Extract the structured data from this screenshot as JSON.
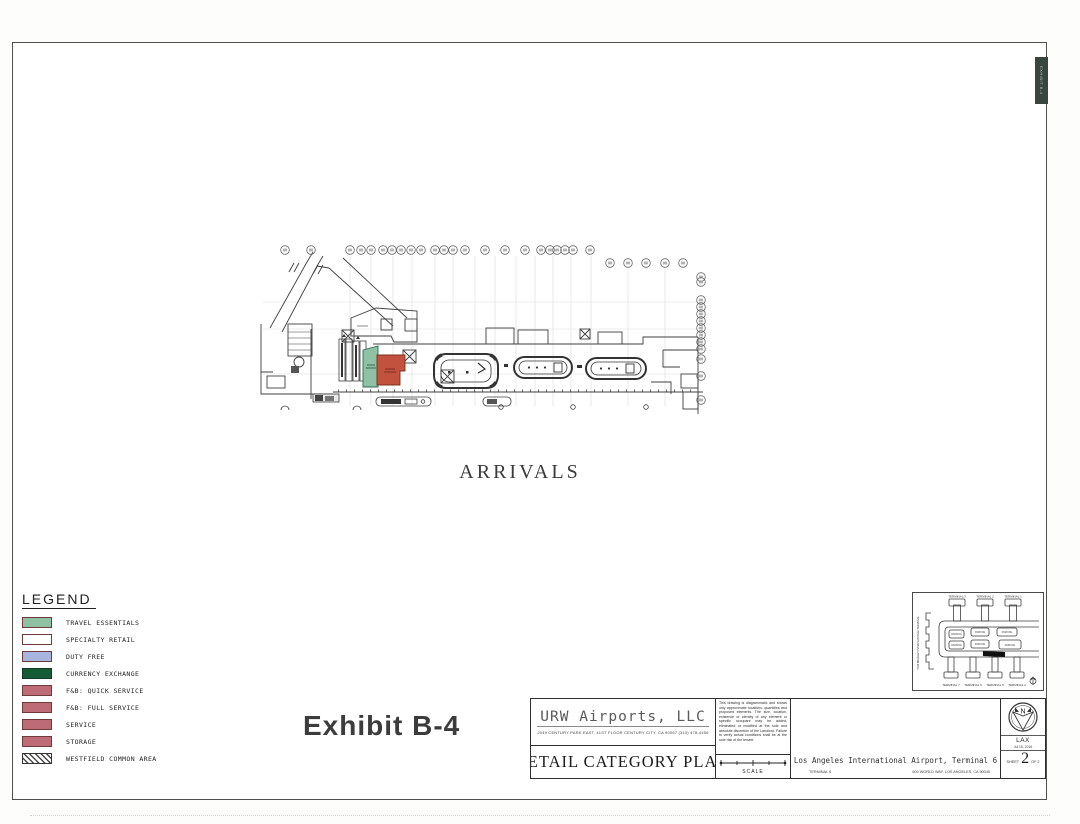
{
  "page": {
    "exhibit_label": "Exhibit B-4",
    "arrivals_label": "ARRIVALS",
    "side_tab_label": "EXHIBIT B-4"
  },
  "legend": {
    "title": "LEGEND",
    "items": [
      {
        "label": "TRAVEL ESSENTIALS",
        "color": "#8fc2a5",
        "type": "fill"
      },
      {
        "label": "SPECIALTY RETAIL",
        "color": "#ffffff",
        "type": "outline"
      },
      {
        "label": "DUTY FREE",
        "color": "#a6b4de",
        "type": "fill"
      },
      {
        "label": "CURRENCY EXCHANGE",
        "color": "#155c36",
        "type": "fill"
      },
      {
        "label": "F&B: QUICK SERVICE",
        "color": "#bd6b76",
        "type": "fill"
      },
      {
        "label": "F&B: FULL SERVICE",
        "color": "#bd6b76",
        "type": "fill"
      },
      {
        "label": "SERVICE",
        "color": "#bd6b76",
        "type": "fill"
      },
      {
        "label": "STORAGE",
        "color": "#bd6b76",
        "type": "fill"
      },
      {
        "label": "WESTFIELD COMMON AREA",
        "color": "hatch",
        "type": "hatch"
      }
    ]
  },
  "plan": {
    "rooms": [
      {
        "category": "travel-essentials",
        "color": "#8fc2a5",
        "stroke": "#2d6b52"
      },
      {
        "category": "f-and-b-quick-service",
        "color": "#c2523e",
        "stroke": "#7d2f1f"
      }
    ]
  },
  "title_block": {
    "company_name": "URW Airports, LLC",
    "company_address": "2049 CENTURY PARK EAST, 41ST FLOOR CENTURY CITY, CA 90067   (310) 478-4456",
    "drawing_title": "RETAIL CATEGORY PLAN",
    "disclaimer": "This drawing is diagrammatic and shows only approximate locations, quantities and proposed elements. The size, location, existence or identity of any element or specific occupant may be added, eliminated or modified at the sole and absolute discretion of the Landlord. Failure to verify actual conditions shall be at the sole risk of the tenant.",
    "scale_label": "SCALE",
    "project_name": "Los Angeles International Airport, Terminal 6",
    "project_terminal": "TERMINAL 6",
    "project_address": "600 WORLD WAY, LOS ANGELES, CA 90045",
    "north_letter": "N",
    "airport_code": "LAX",
    "date": "Jul 16, 2016",
    "sheet_label": "SHEET",
    "sheet_number": "2",
    "sheet_of": "OF 2"
  },
  "inset_map": {
    "left_label": "TOM BRADLEY INTERNATIONAL TERMINAL",
    "top_labels": [
      "TERMINAL 3",
      "TERMINAL 2",
      "TERMINAL 1"
    ],
    "bottom_labels": [
      "TERMINAL 7",
      "TERMINAL 6",
      "TERMINAL 5",
      "TERMINAL 4"
    ],
    "parking_label": "PARKING"
  }
}
